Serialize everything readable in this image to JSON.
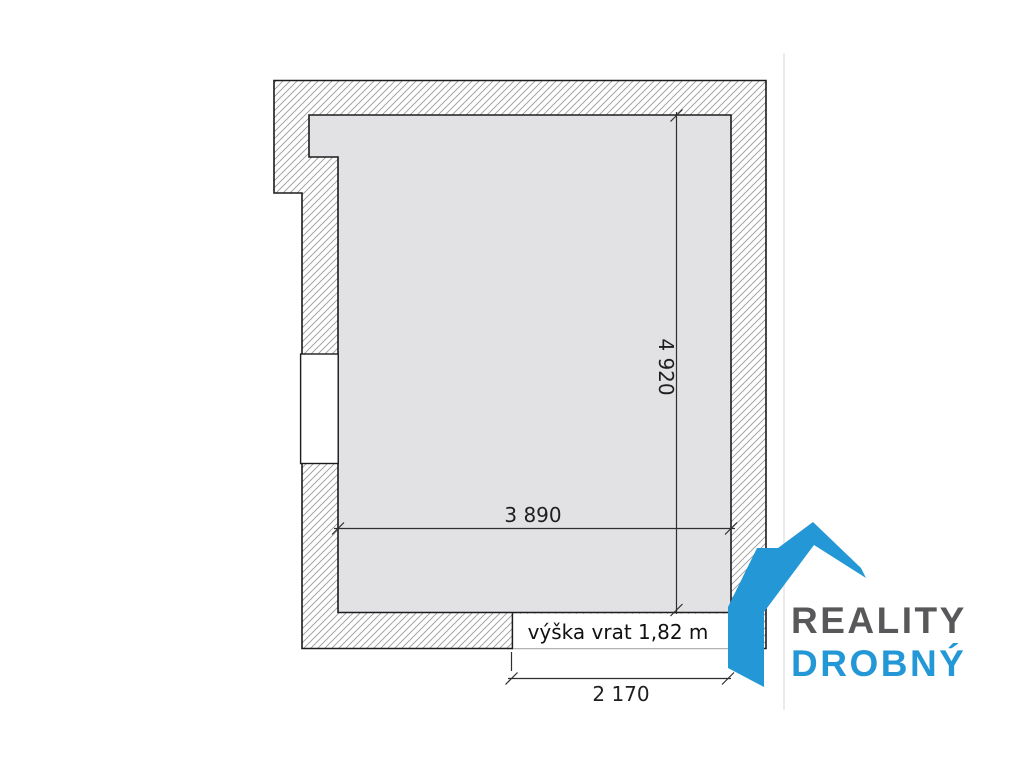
{
  "plan": {
    "type": "floor-plan",
    "room": {
      "width_label": "3 890",
      "height_label": "4 920",
      "door_width_label": "2 170",
      "door_note": "výška vrat 1,82 m"
    },
    "colors": {
      "room_fill": "#e2e2e4",
      "hatch_line": "#9a9a9a",
      "outline": "#1c1c1c",
      "dimension_line": "#2f2f2f",
      "gate_line": "#a9a9a9",
      "photo_edge": "#ebebeb"
    }
  },
  "logo": {
    "line1": "REALITY",
    "line2": "DROBNÝ",
    "accent_color": "#2498d6",
    "text_color": "#58585a"
  }
}
